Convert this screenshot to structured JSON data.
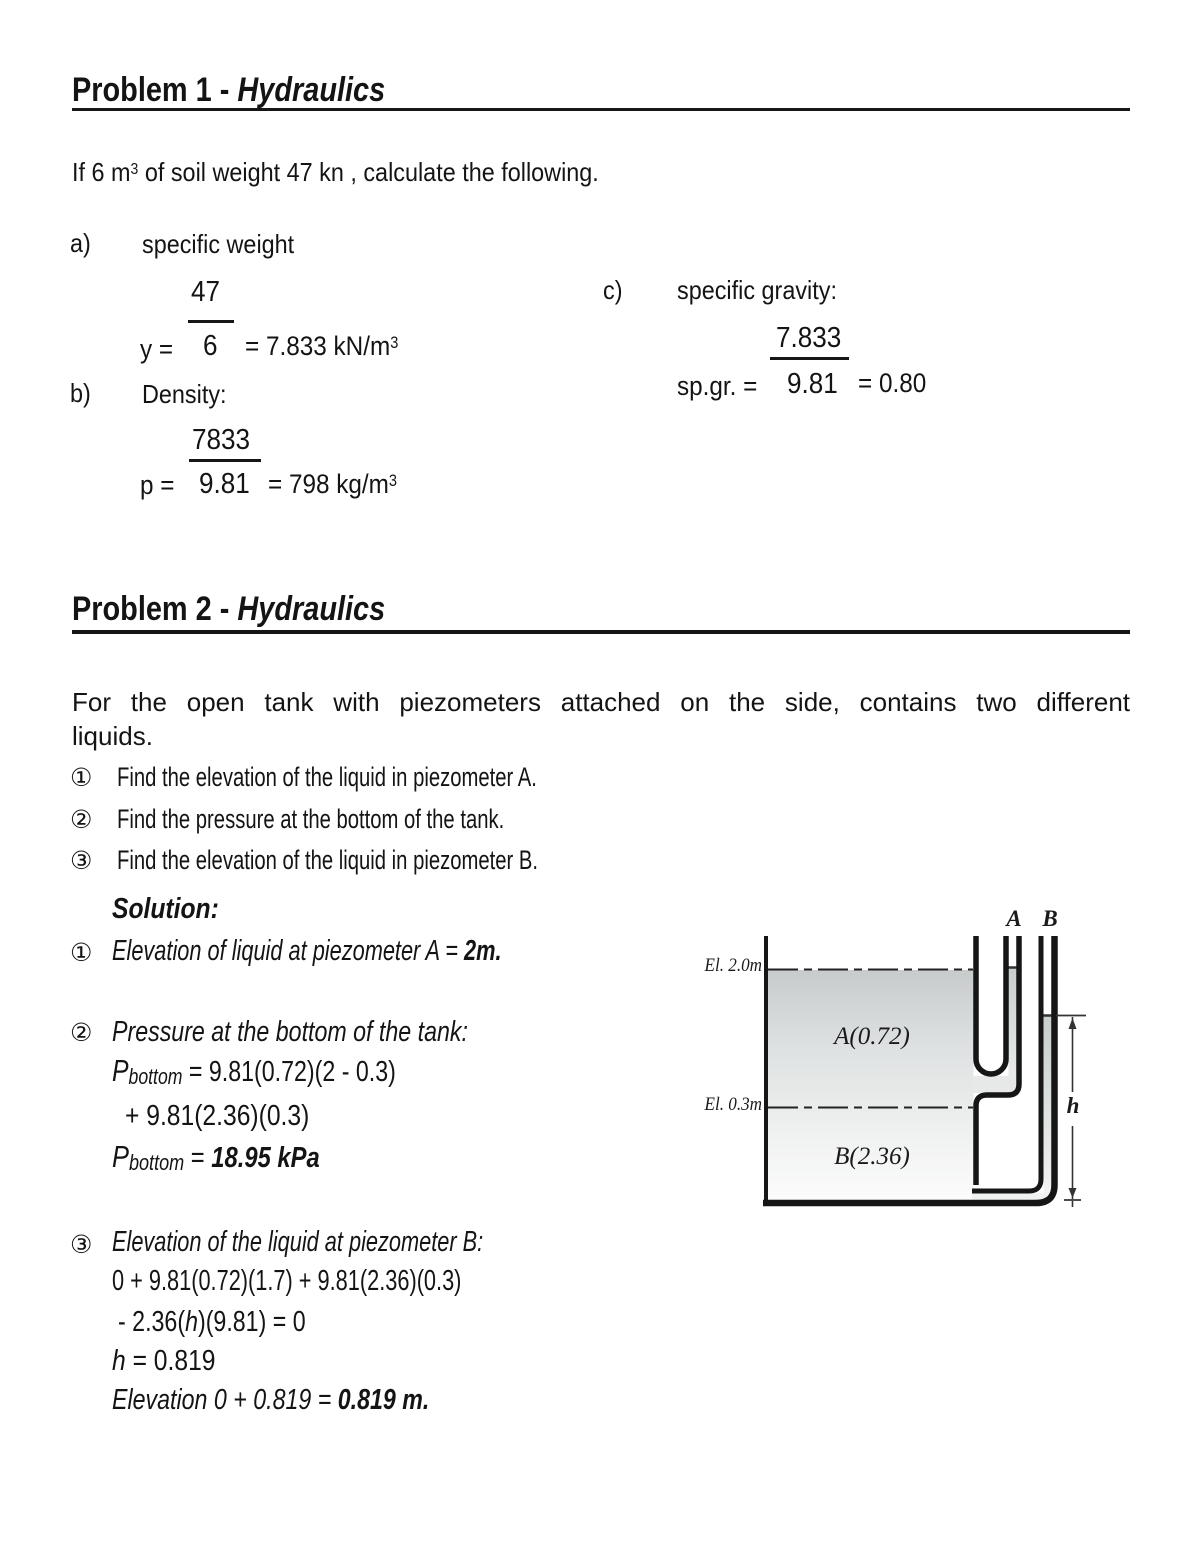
{
  "problem1": {
    "title": {
      "prefix": "Problem 1 - ",
      "subject": "Hydraulics"
    },
    "intro": {
      "pre": "If 6 m",
      "sup": "3",
      "post": " of soil weight 47 kn , calculate the following."
    },
    "part_a": {
      "label": "a)",
      "name": "specific weight",
      "numerator": "47",
      "lhs": "y =",
      "denominator": "6",
      "result": "= 7.833 kN/m",
      "result_sup": "3"
    },
    "part_b": {
      "label": "b)",
      "name": "Density:",
      "numerator": "7833",
      "lhs": "p =",
      "denominator": "9.81",
      "result": "= 798 kg/m",
      "result_sup": "3"
    },
    "part_c": {
      "label": "c)",
      "name": "specific gravity:",
      "numerator": "7.833",
      "lhs": "sp.gr. =",
      "denominator": "9.81",
      "result": "= 0.80"
    }
  },
  "problem2": {
    "title": {
      "prefix": "Problem 2 - ",
      "subject": "Hydraulics"
    },
    "intro_line1": "For the open tank with piezometers attached on the side, contains two different",
    "intro_line2": "liquids.",
    "questions": [
      {
        "num": "①",
        "text": "Find the elevation of the liquid in piezometer A."
      },
      {
        "num": "②",
        "text": "Find the pressure at the bottom of the tank."
      },
      {
        "num": "③",
        "text": "Find the elevation of the liquid in piezometer B."
      }
    ],
    "solution_heading": "Solution:",
    "s1": {
      "num": "①",
      "text": "Elevation of liquid at piezometer A = ",
      "answer": "2m."
    },
    "s2": {
      "num": "②",
      "title": "Pressure at the bottom of the tank:",
      "eq1_p": "P",
      "eq1_sub": "bottom",
      "eq1_rest": " = 9.81(0.72)(2 - 0.3)",
      "eq2": "+ 9.81(2.36)(0.3)",
      "eq3_p": "P",
      "eq3_sub": "bottom",
      "eq3_eq": " = ",
      "eq3_answer": "18.95 kPa"
    },
    "s3": {
      "num": "③",
      "title": "Elevation of the liquid at piezometer B:",
      "eq1": "0 + 9.81(0.72)(1.7) + 9.81(2.36)(0.3)",
      "eq2_pre": "- 2.36(",
      "eq2_var": "h",
      "eq2_post": ")(9.81) = 0",
      "eq3_var": "h",
      "eq3_rest": " = 0.819",
      "eq4": "Elevation 0 + 0.819 = ",
      "eq4_answer": "0.819 m."
    }
  },
  "diagram": {
    "elevation_top": "El. 2.0m",
    "elevation_mid": "El. 0.3m",
    "piezometer_a": "A",
    "piezometer_b": "B",
    "liquid_a": "A(0.72)",
    "liquid_b": "B(2.36)",
    "height_label": "h"
  }
}
